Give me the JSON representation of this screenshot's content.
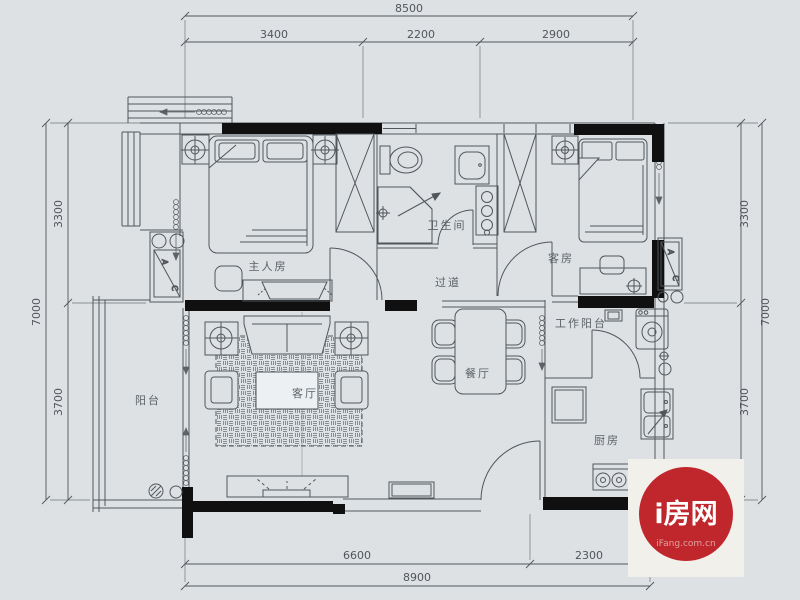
{
  "colors": {
    "bg": "#dde1e4",
    "line": "#51565b",
    "wall": "#101010",
    "text": "#5c6268",
    "dim": "#51565b",
    "logo_bg": "#f2f0ea",
    "logo_red": "#c0272d",
    "logo_sub": "#dfa39f"
  },
  "plan": {
    "rooms": {
      "master": {
        "label": "主人房"
      },
      "bath": {
        "label": "卫生间"
      },
      "corridor": {
        "label": "过道"
      },
      "guest": {
        "label": "客房"
      },
      "living": {
        "label": "客厅"
      },
      "dining": {
        "label": "餐厅"
      },
      "workbal": {
        "label": "工作阳台"
      },
      "kitchen": {
        "label": "厨房"
      },
      "balcony": {
        "label": "阳台"
      }
    },
    "dimensions": {
      "top": {
        "total": "8500",
        "segments": [
          "3400",
          "2200",
          "2900"
        ]
      },
      "left": {
        "total": "7000",
        "segments": [
          "3300",
          "3700"
        ]
      },
      "right": {
        "total": "7000",
        "segments": [
          "3300",
          "3700"
        ]
      },
      "bottom": {
        "total": "8900",
        "segments": [
          "6600",
          "2300"
        ]
      }
    },
    "ac_unit": {
      "a": "A",
      "c": "C"
    }
  },
  "logo": {
    "title": "i房网",
    "subtitle": "iFang.com.cn"
  }
}
